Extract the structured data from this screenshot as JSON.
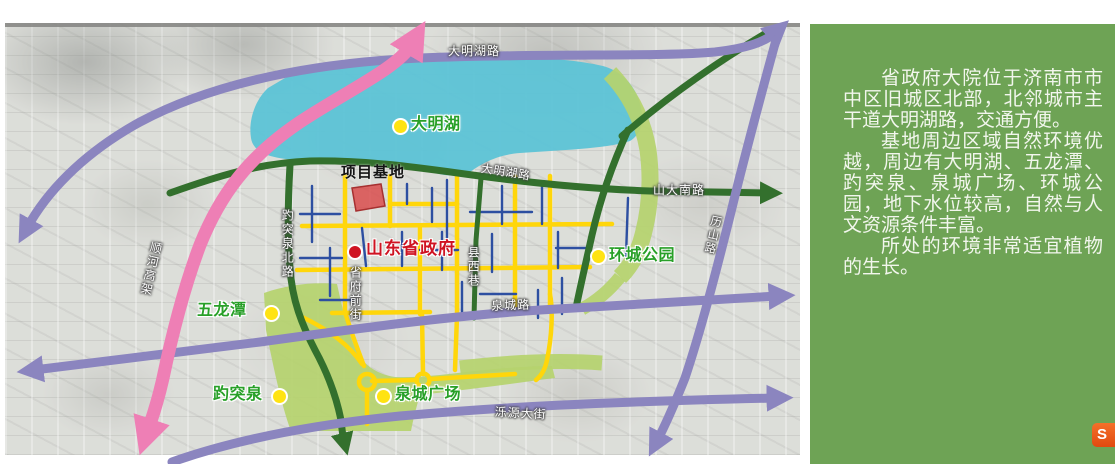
{
  "map": {
    "site_label": "项目基地",
    "government_label": "山东省政府",
    "roads": {
      "daminghu_top": "大明湖路",
      "daminghu_inner": "大明湖路",
      "shanda_south": "山大南路",
      "lishan": "历山路",
      "baotuquan_north": "趵突泉北路",
      "xianxi_lane": "县西巷",
      "shengfu_front": "省府前街",
      "quancheng": "泉城路",
      "luoyuan": "泺源大街",
      "shunhe_elevated": "顺河高架"
    },
    "pois": {
      "daming_lake": "大明湖",
      "huancheng_park": "环城公园",
      "wulongtan": "五龙潭",
      "baotu_spring": "趵突泉",
      "quancheng_square": "泉城广场"
    }
  },
  "panel": {
    "paragraphs": {
      "p1": "省政府大院位于济南市市中区旧城区北部，北邻城市主干道大明湖路，交通方便。",
      "p2": "基地周边区域自然环境优越，周边有大明湖、五龙潭、趵突泉、泉城广场、环城公园，地下水位较高，自然与人文资源条件丰富。",
      "p3": "所处的环境非常适宜植物的生长。"
    },
    "logo_letter": "S"
  },
  "colors": {
    "panel_green": "#6ea355",
    "lake_blue": "#5cc3d6",
    "park_green": "#b5d36e",
    "road_pink": "#ee7fb5",
    "road_purple": "#8b85bf",
    "road_dark_green": "#33702d",
    "road_yellow": "#ffd60a",
    "road_blue": "#2d4fa1",
    "site_red": "#d94848",
    "poi_text_green": "#28a028",
    "gov_red": "#cf1322",
    "dot_yellow": "#ffe312"
  }
}
